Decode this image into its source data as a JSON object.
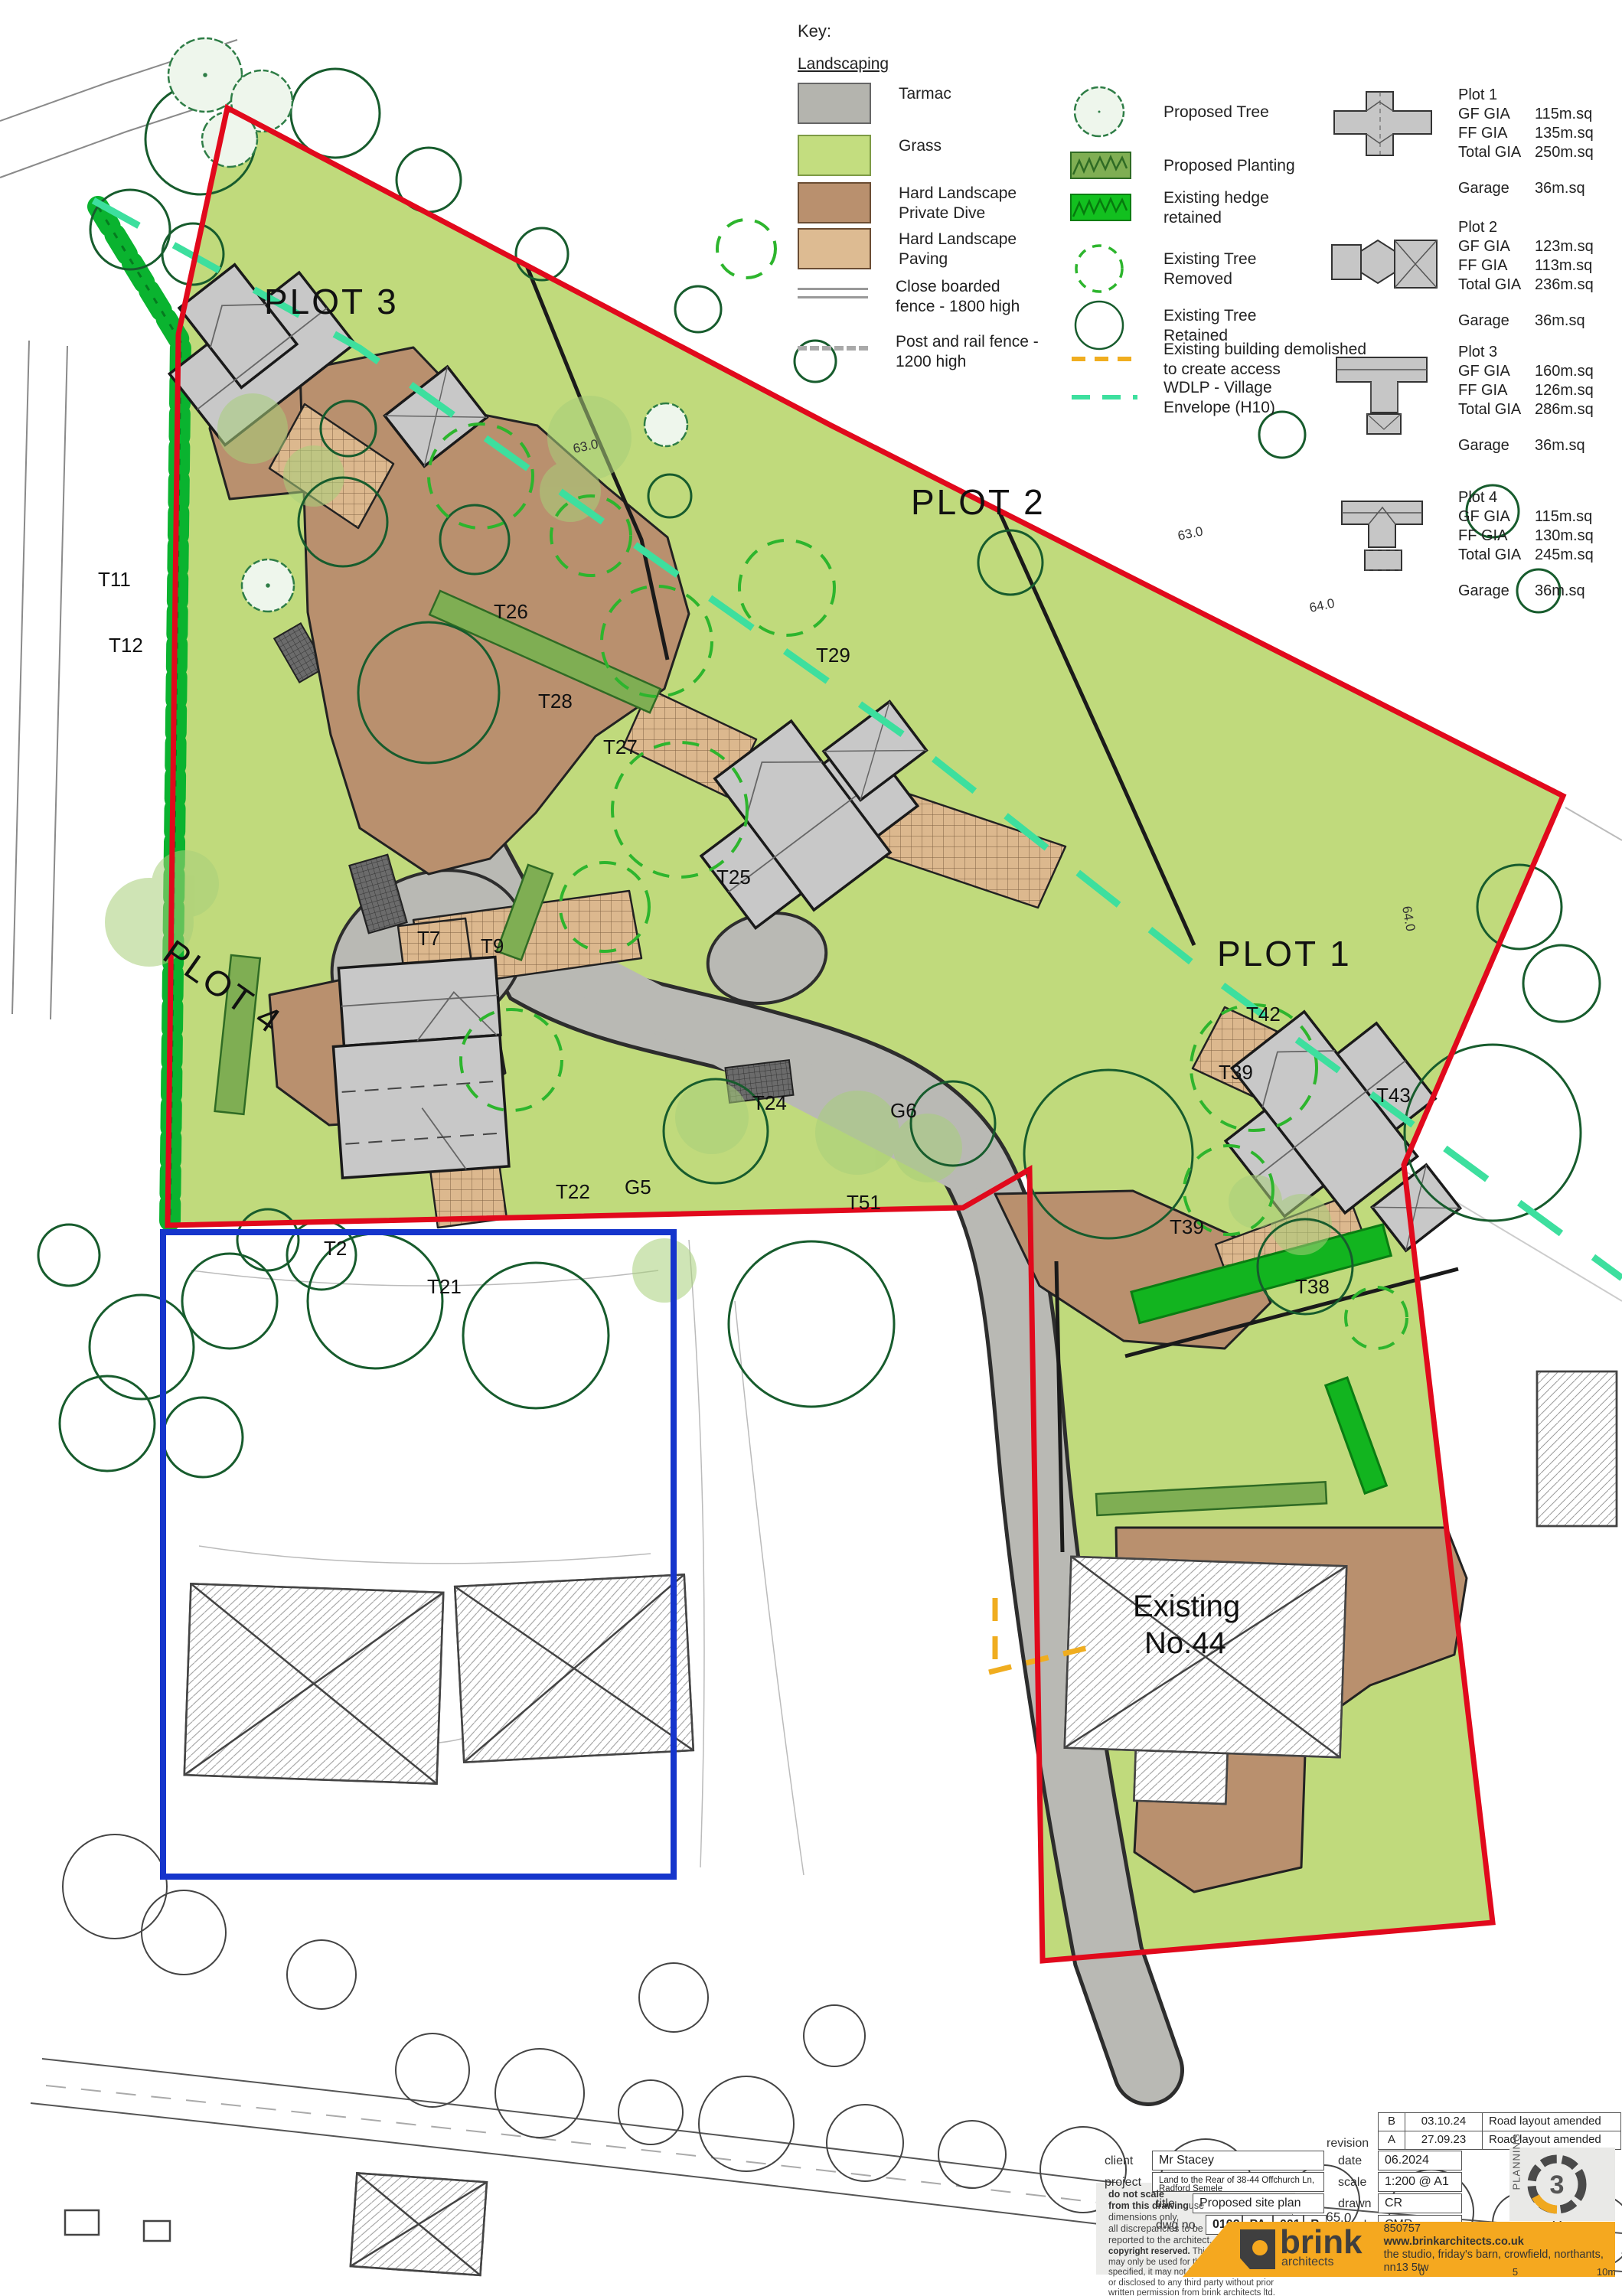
{
  "legend": {
    "title": "Key:",
    "subtitle": "Landscaping",
    "items_left": [
      {
        "label": "Tarmac"
      },
      {
        "label": "Grass"
      },
      {
        "label": "Hard Landscape\nPrivate Dive"
      },
      {
        "label": "Hard Landscape\nPaving"
      },
      {
        "label": "Close boarded\nfence - 1800 high"
      },
      {
        "label": "Post and rail fence -\n1200 high"
      }
    ],
    "items_right": [
      {
        "label": "Proposed Tree"
      },
      {
        "label": "Proposed Planting"
      },
      {
        "label": "Existing hedge\nretained"
      },
      {
        "label": "Existing Tree\nRemoved"
      },
      {
        "label": "Existing Tree\nRetained"
      },
      {
        "label": "Existing building demolished\nto create access"
      },
      {
        "label": "WDLP - Village\nEnvelope (H10)"
      }
    ]
  },
  "plots": [
    {
      "name": "Plot 1",
      "gf_label": "GF GIA",
      "gf": "115m.sq",
      "ff_label": "FF GIA",
      "ff": "135m.sq",
      "total_label": "Total GIA",
      "total": "250m.sq",
      "garage_label": "Garage",
      "garage": "36m.sq"
    },
    {
      "name": "Plot 2",
      "gf_label": "GF GIA",
      "gf": "123m.sq",
      "ff_label": "FF GIA",
      "ff": "113m.sq",
      "total_label": "Total GIA",
      "total": "236m.sq",
      "garage_label": "Garage",
      "garage": "36m.sq"
    },
    {
      "name": "Plot 3",
      "gf_label": "GF GIA",
      "gf": "160m.sq",
      "ff_label": "FF GIA",
      "ff": "126m.sq",
      "total_label": "Total GIA",
      "total": "286m.sq",
      "garage_label": "Garage",
      "garage": "36m.sq"
    },
    {
      "name": "Plot 4",
      "gf_label": "GF GIA",
      "gf": "115m.sq",
      "ff_label": "FF GIA",
      "ff": "130m.sq",
      "total_label": "Total GIA",
      "total": "245m.sq",
      "garage_label": "Garage",
      "garage": "36m.sq"
    }
  ],
  "map": {
    "plot1": "PLOT 1",
    "plot2": "PLOT 2",
    "plot3": "PLOT 3",
    "plot4": "PLOT 4",
    "existing_line1": "Existing",
    "existing_line2": "No.44",
    "tags": {
      "t11": "T11",
      "t12": "T12",
      "t7": "T7",
      "t9": "T9",
      "t26": "T26",
      "t27": "T27",
      "t28": "T28",
      "t29": "T29",
      "t25": "T25",
      "t24": "T24",
      "t51": "T51",
      "g5": "G5",
      "g6": "G6",
      "t22": "T22",
      "t2x": "T2",
      "t21": "T21",
      "t38": "T38",
      "t39a": "T39",
      "t39b": "T39",
      "t42": "T42",
      "t43": "T43"
    },
    "contours": {
      "c63a": "63.0",
      "c63b": "63.0",
      "c64a": "64.0",
      "c64b": "64.0",
      "c65": "65.0"
    }
  },
  "titleblock": {
    "revision_label": "revision",
    "revisions": [
      {
        "rev": "B",
        "date": "03.10.24",
        "note": "Road layout amended"
      },
      {
        "rev": "A",
        "date": "27.09.23",
        "note": "Road layout amended"
      }
    ],
    "client_label": "client",
    "client": "Mr Stacey",
    "project_label": "project",
    "project": "Land to the Rear of 38-44 Offchurch Ln, Radford Semele",
    "title_label": "title",
    "title": "Proposed site plan",
    "dwg_label": "dwg no.",
    "dwg": [
      "0102",
      "PA",
      "001",
      "B"
    ],
    "date_label": "date",
    "date": "06.2024",
    "scale_label": "scale",
    "scale": "1:200 @ A1",
    "drawn_label": "drawn",
    "drawn": "CR",
    "check_label": "check",
    "check": "CMR",
    "dns_bold": "do not scale\nfrom this drawing",
    "dns_rest": "use dimensions only,\nall discrepancies to be\nreported to the architect.",
    "copy_bold": "copyright reserved.",
    "copy_rest": " This drawing\nmay only be used for the client and location\nspecified, it may not be copied\nor disclosed to any third party without prior\nwritten permission from brink architects ltd."
  },
  "stamp": {
    "label": "PLANNING",
    "number": "3"
  },
  "brand": {
    "email_label": "e:",
    "email": "info@brinkarchitects.co.uk",
    "tel_label": "t:",
    "tel": "01280 850757",
    "web": "www.brinkarchitects.co.uk",
    "address": "the studio, friday's barn, crowfield, northants, nn13 5tw",
    "ratio": "1:200",
    "s0": "0",
    "s5": "5",
    "s10": "10m"
  },
  "colors": {
    "boundary_red": "#e1091c",
    "boundary_blue": "#1535cc",
    "wdlp_teal": "#3ddf9e",
    "demolish_yellow": "#f0ad1f",
    "grass": "#c0da7c",
    "tarmac": "#b9b9b4",
    "private_drive": "#b9906e",
    "paving": "#dcb88e",
    "hedge_green": "#0ab32f",
    "tree_dark_green": "#175c2d",
    "tree_removed_green": "#2db52d",
    "brand_yellow": "#f5a81f"
  }
}
